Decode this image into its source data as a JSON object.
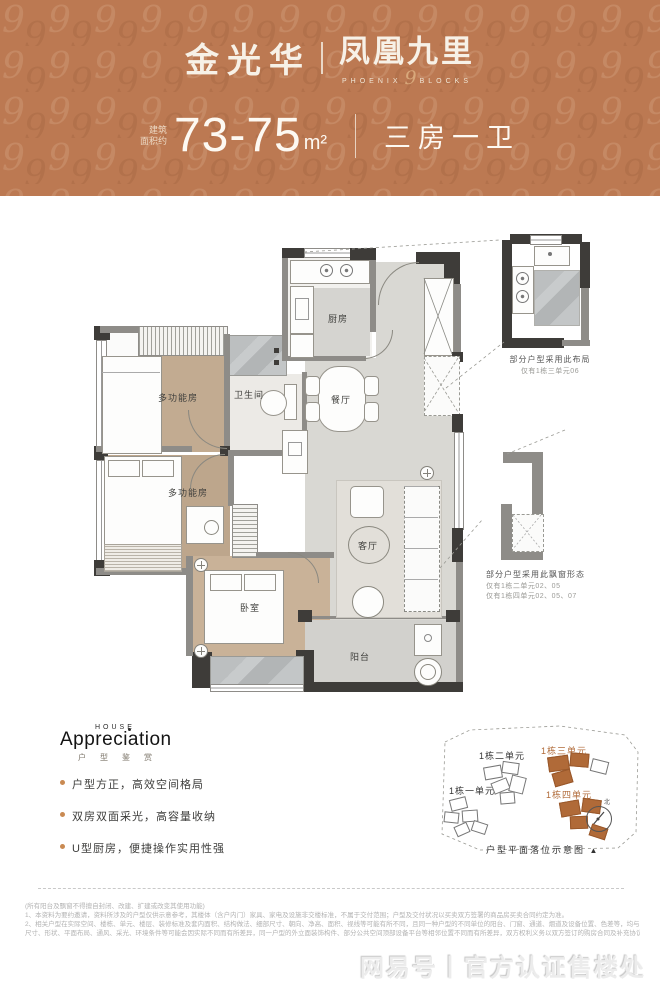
{
  "header": {
    "brand_left": "金光华",
    "brand_right": "凤凰九里",
    "brand_sub_left": "PHOENIX",
    "brand_sub_num": "9",
    "brand_sub_right": "BLOCKS",
    "area_label_line1": "建筑",
    "area_label_line2": "面积约",
    "area_value": "73-75",
    "area_unit": "m²",
    "layout_type": "三房一卫"
  },
  "plan": {
    "rooms": {
      "kitchen": "厨房",
      "bathroom": "卫生间",
      "dining": "餐厅",
      "multi_upper": "多功能房",
      "multi_lower": "多功能房",
      "bedroom": "卧室",
      "living": "客厅",
      "balcony": "阳台"
    },
    "callout_kitchen": {
      "title": "部分户型采用此布局",
      "note": "仅有1栋三单元06"
    },
    "callout_bay": {
      "title": "部分户型采用此飘窗形态",
      "note1": "仅有1栋二单元02、05",
      "note2": "仅有1栋四单元02、05、07"
    }
  },
  "appreciation": {
    "kicker": "HOUSE",
    "title": "Appreciation",
    "subtitle": "户型鉴赏",
    "bullets": [
      "户型方正，高效空间格局",
      "双房双面采光，高容量收纳",
      "U型厨房，便捷操作实用性强"
    ]
  },
  "siteplan": {
    "unit1": "1栋一单元",
    "unit2": "1栋二单元",
    "unit3": "1栋三单元",
    "unit4": "1栋四单元",
    "caption": "户型平面落位示意图",
    "compass_marker": "▲",
    "north": "北"
  },
  "footer": {
    "line0": "(所有阳台及飘窗不得擅自封闭、改建、扩建或改变其使用功能)",
    "line1": "1、本资料为要约邀请，资料所涉及的户型仅供示意参考，其楼体（含户内门）家具、家电及设施非交楼标准，不属于交付范围；户型及交付状况以买卖双方签署的商品房买卖合同约定为准。",
    "line2": "2、相关户型在实际空间、楼栋、单元、楼层、装修标准及套内面积、结构做法、细部尺寸、朝向、净高、面积、视线等可能有所不同，且同一种户型的不同单位的阳台、门窗、通道、烟道及设备位置、色差等，均与本图示的尺寸位置等可能不同，每一单位均有细微差别，",
    "line3": "尺寸、形状、平面布局、通风、采光、环境条件等可能会因实际不同而有所差异，同一户型的外立面装饰构件、部分公共空间顶部设备平台等相邻位置不同而有所差异，双方权利义务以双方签订的购房合同及补充协议约定等相关文件及实际交付为准。"
  },
  "watermark": {
    "text": "网易号丨官方认证售楼处"
  },
  "colors": {
    "header_bg": "#bc7952",
    "wall": "#3e3c39",
    "wood": "#c0a98f",
    "accent": "#b06a38"
  }
}
